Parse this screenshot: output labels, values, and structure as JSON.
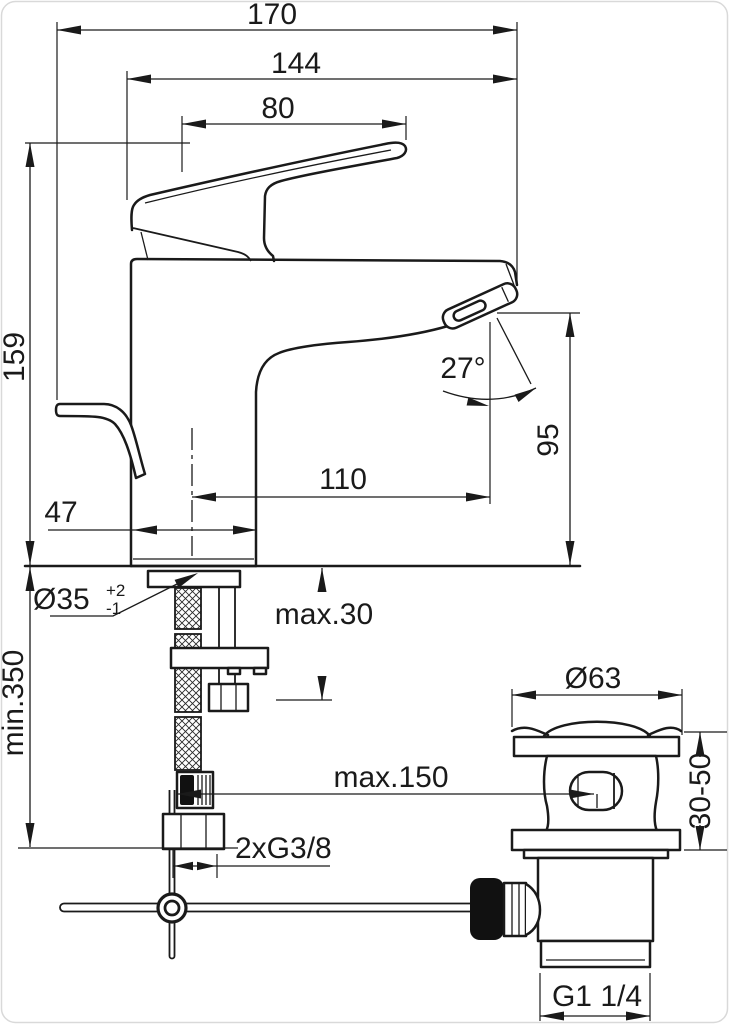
{
  "dims": {
    "d170": "170",
    "d144": "144",
    "d80": "80",
    "d159": "159",
    "d27": "27°",
    "d95": "95",
    "d110": "110",
    "d47": "47",
    "d35": "Ø35",
    "d35_tol_plus": "+2",
    "d35_tol_minus": "-1",
    "max30": "max.30",
    "min350": "min.350",
    "d63": "Ø63",
    "max150": "max.150",
    "d3050": "30-50",
    "g38": "2xG3/8",
    "g114": "G1 1/4"
  },
  "colors": {
    "line": "#1a1a1a",
    "background": "#ffffff",
    "border": "#d9d9d9"
  }
}
